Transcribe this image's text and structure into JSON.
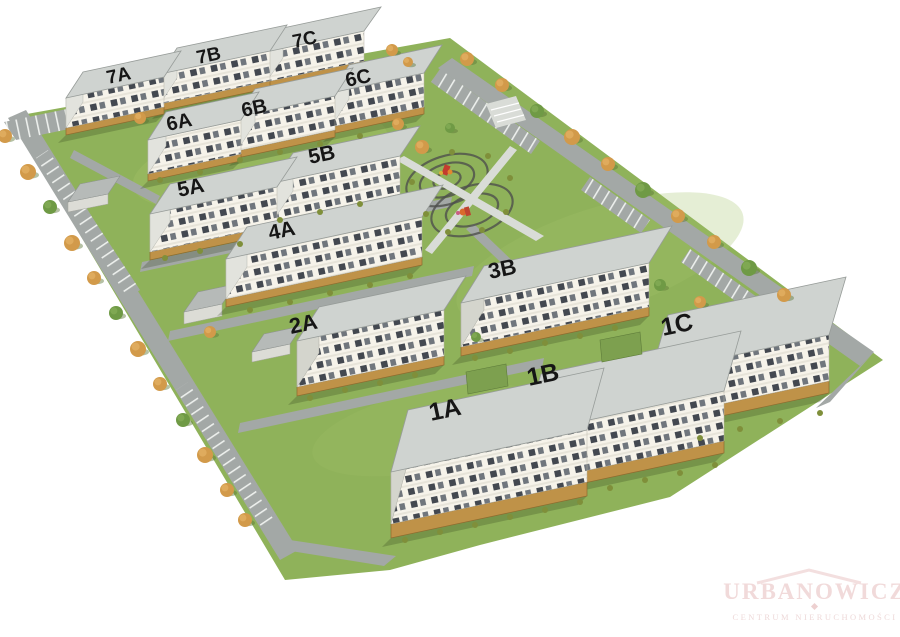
{
  "scene_title": "Residential estate 3D site plan",
  "buildings": [
    {
      "label": "7A"
    },
    {
      "label": "7B"
    },
    {
      "label": "7C"
    },
    {
      "label": "6A"
    },
    {
      "label": "6B"
    },
    {
      "label": "6C"
    },
    {
      "label": "5A"
    },
    {
      "label": "5B"
    },
    {
      "label": "4A"
    },
    {
      "label": "3B"
    },
    {
      "label": "2A"
    },
    {
      "label": "1A"
    },
    {
      "label": "1B"
    },
    {
      "label": "1C"
    }
  ],
  "watermark": {
    "name": "URBANOWICZ",
    "subtitle": "CENTRUM NIERUCHOMOŚCI"
  },
  "colors": {
    "grass": "#8fb25a",
    "grass_light": "#a3c168",
    "road": "#a3a8a6",
    "path": "#d9dcd7",
    "roof": "#cfd3d0",
    "garage_roof": "#b6bab8",
    "wing_roof": "#7da04f",
    "sidewall": "#e2e3dd",
    "ground_strip": "#bf9248",
    "tree_autumn": "#d29a4a",
    "tree_green": "#6f9a45",
    "bush": "#7f8f3a",
    "label": "#161616",
    "watermark": "#f1dada",
    "background": "#ffffff"
  }
}
